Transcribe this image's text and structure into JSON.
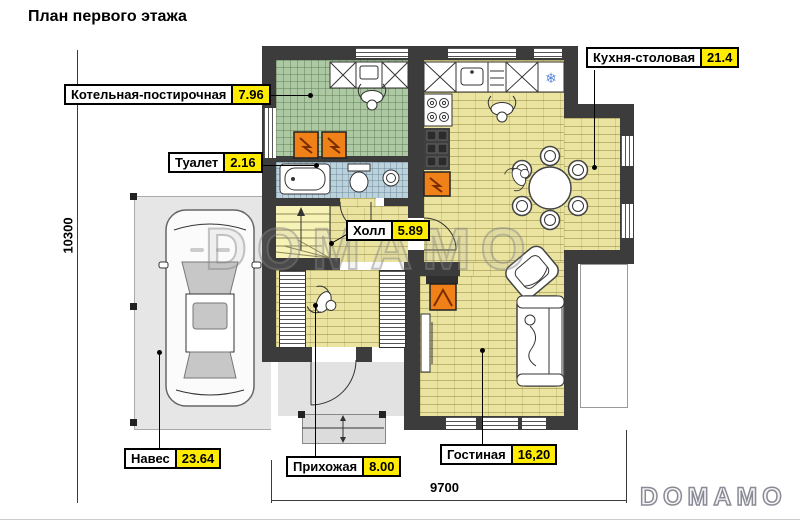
{
  "title": "План первого этажа",
  "watermark": "DOMAMO",
  "brand_logo": "DOMAMO",
  "dimensions": {
    "overall_height_mm": "10300",
    "overall_width_mm": "9700"
  },
  "rooms": [
    {
      "name": "Котельная-постирочная",
      "area": "7.96"
    },
    {
      "name": "Туалет",
      "area": "2.16"
    },
    {
      "name": "Кухня-столовая",
      "area": "21.4"
    },
    {
      "name": "Холл",
      "area": "5.89"
    },
    {
      "name": "Навес",
      "area": "23.64"
    },
    {
      "name": "Прихожая",
      "area": "8.00"
    },
    {
      "name": "Гостиная",
      "area": "16,20"
    }
  ],
  "icons": {
    "fridge_snowflake": "❄"
  },
  "colors": {
    "wall": "#3c3c3c",
    "floor_yellow": "#eae4a0",
    "tile_green": "#adc9a3",
    "tile_blue": "#bcd2da",
    "stairs_yellow": "#f7f2b6",
    "appliance_orange": "#f08018",
    "area_badge": "#ffec00",
    "carport_gray": "#e6e6e6"
  }
}
